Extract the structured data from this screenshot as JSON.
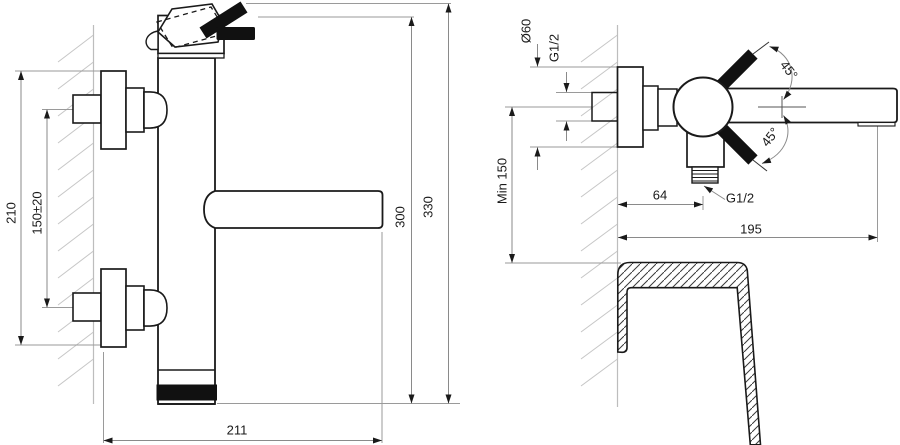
{
  "drawing": {
    "title_hint": "wall-mounted bath mixer tap dimensional drawing",
    "views": {
      "front": "front-view",
      "side": "side-view-with-tub-section"
    },
    "colors": {
      "line": "#1a1a1a",
      "dimension_line": "#8a8a8a",
      "hatch": "#c6c6c6",
      "handle_fill": "#111111",
      "background": "#ffffff"
    }
  },
  "dims": {
    "escutcheon_span": "210",
    "inlet_spacing": "150±20",
    "body_height": "300",
    "total_height": "330",
    "spout_reach": "211",
    "escutcheon_diameter": "Ø60",
    "inlet_thread": "G1/2",
    "min_height": "Min 150",
    "outlet_offset": "64",
    "outlet_thread": "G1/2",
    "spout_projection": "195",
    "handle_angle_upper": "45°",
    "handle_angle_lower": "45°"
  }
}
